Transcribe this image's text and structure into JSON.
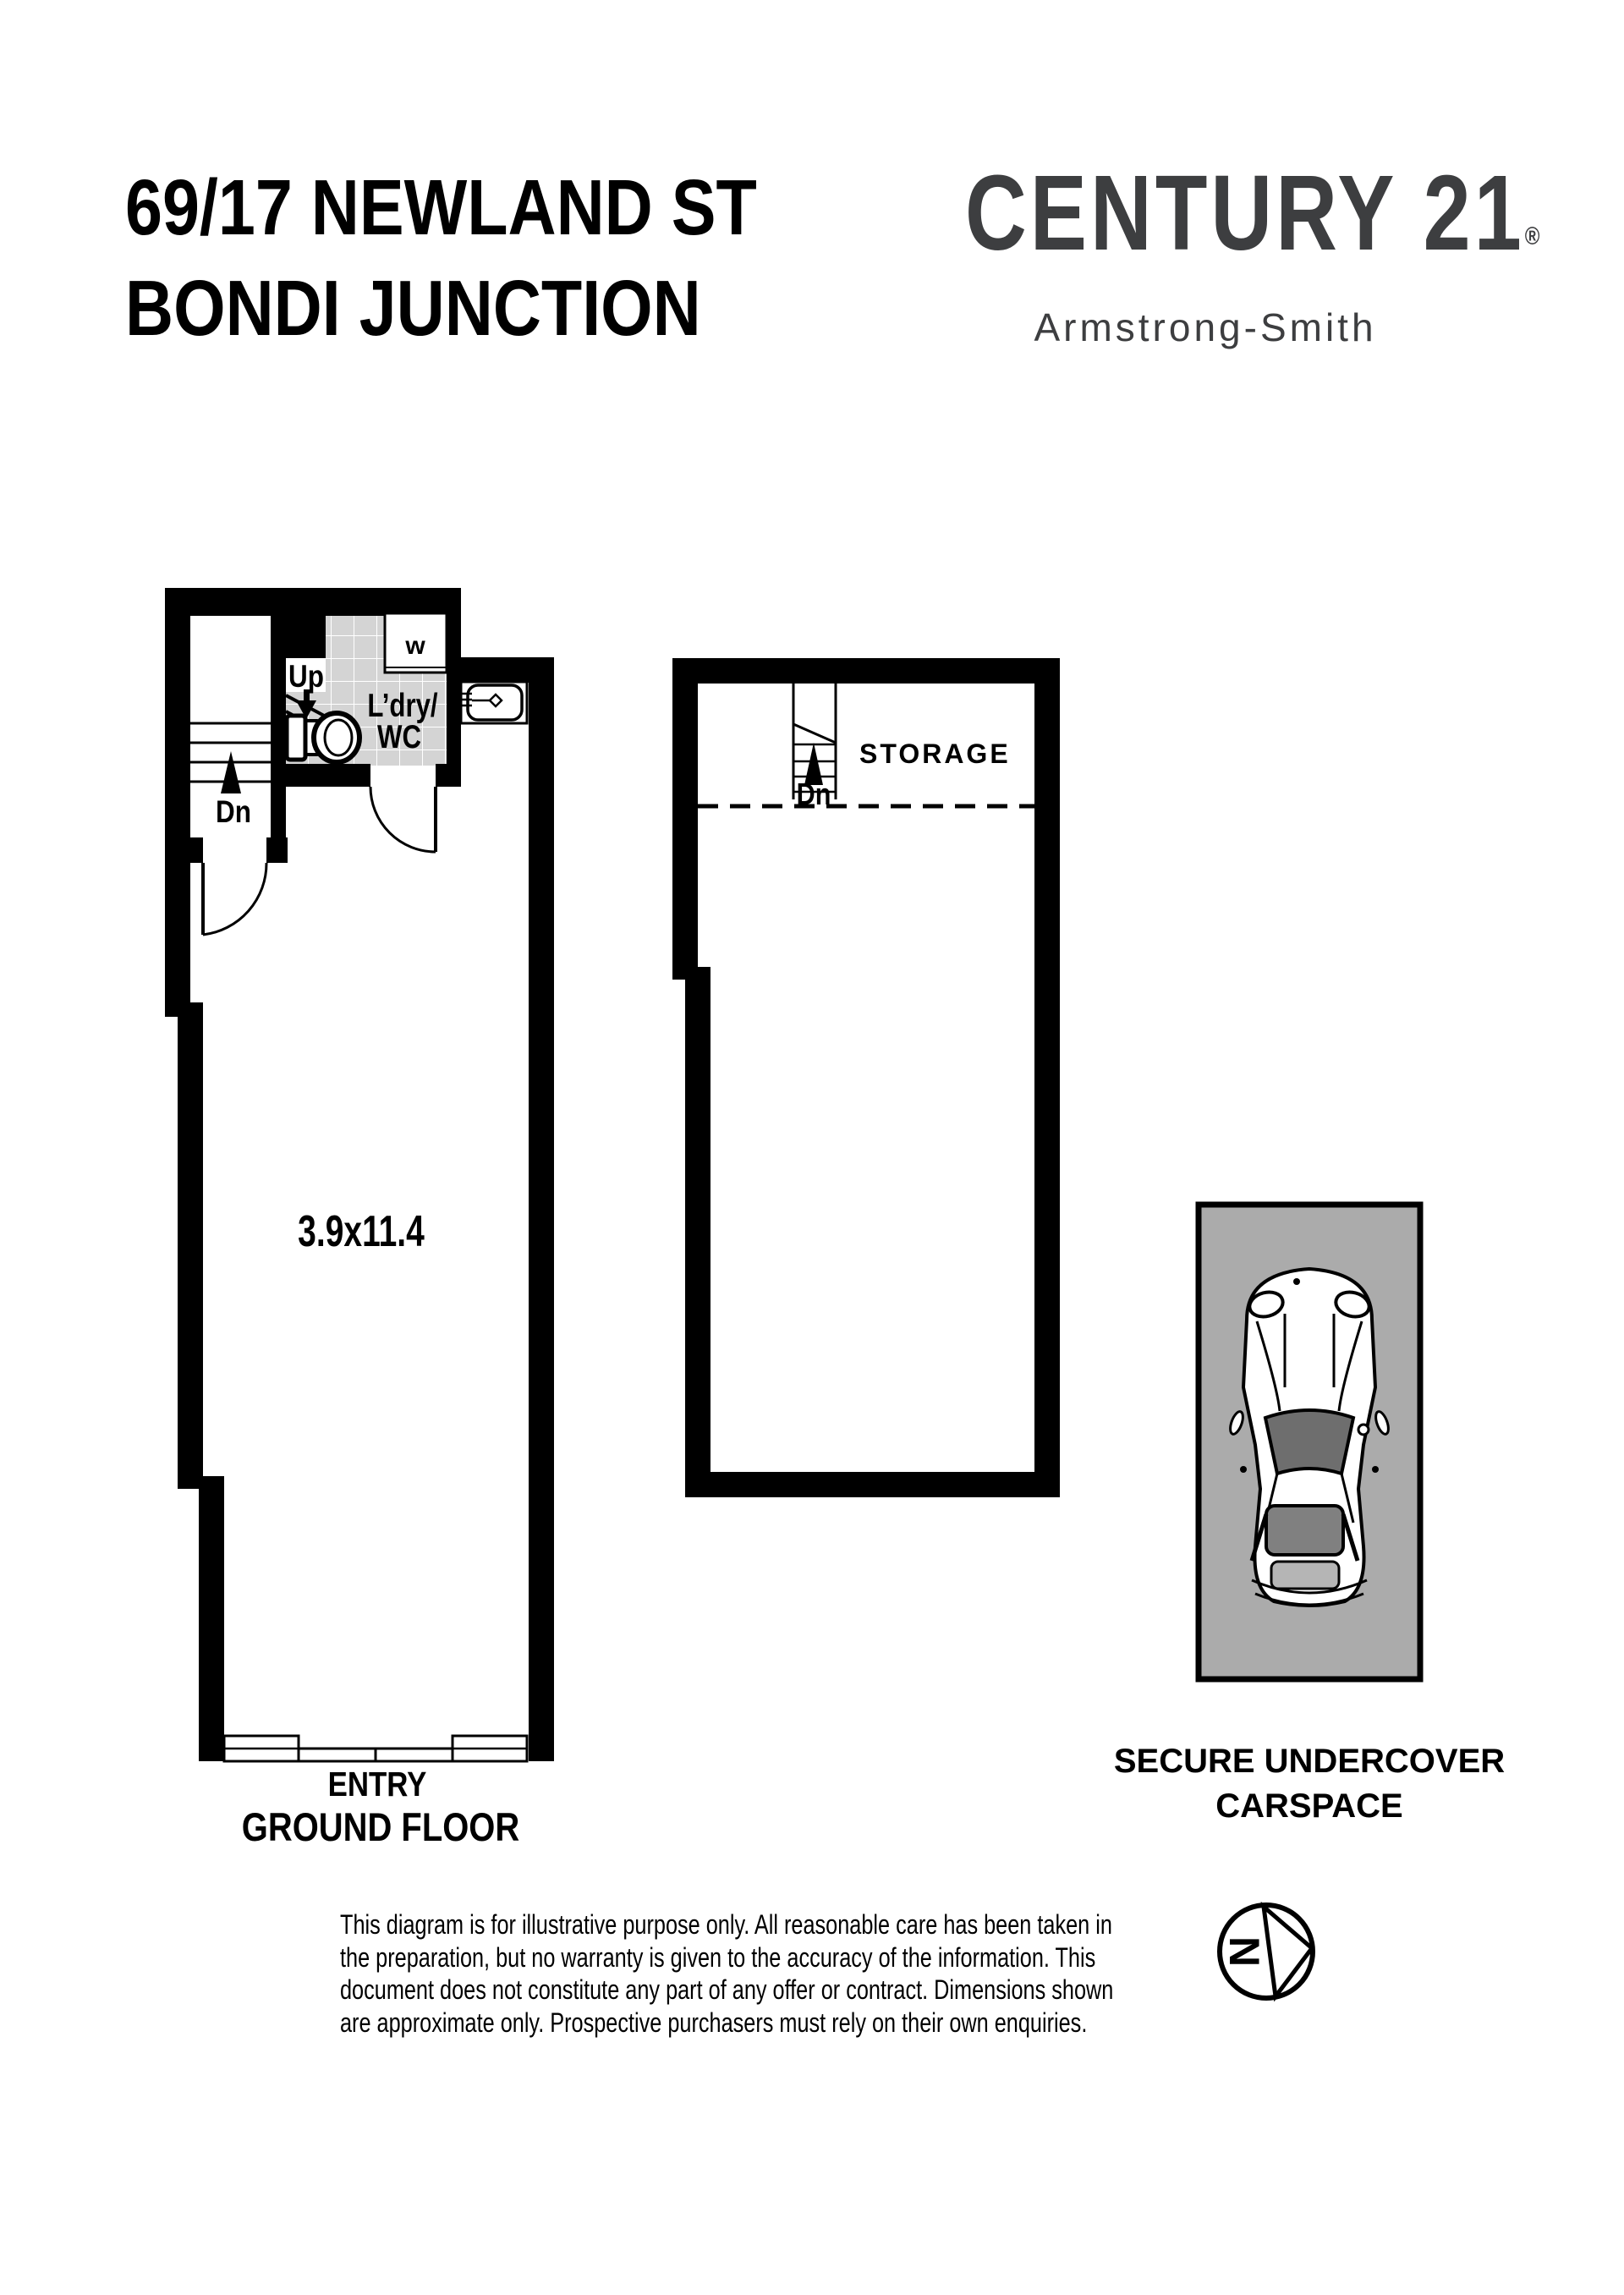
{
  "header": {
    "address_line1": "69/17 NEWLAND ST",
    "address_line2": "BONDI JUNCTION",
    "logo": {
      "brand": "CENTURY 21",
      "registered": "®",
      "office": "Armstrong-Smith",
      "color": "#3d3e40"
    }
  },
  "ground_floor": {
    "labels": {
      "up": "Up",
      "dn": "Dn",
      "laundry_line1": "L’dry/",
      "laundry_line2": "WC",
      "washer": "w",
      "dimensions": "3.9x11.4",
      "entry": "ENTRY",
      "caption": "GROUND FLOOR"
    }
  },
  "storage": {
    "label": "STORAGE",
    "stairs_dn": "Dn"
  },
  "carspace": {
    "caption": "SECURE UNDERCOVER CARSPACE"
  },
  "compass": {
    "north": "N"
  },
  "disclaimer": {
    "lines": [
      "This diagram is for illustrative purpose only. All reasonable care has been taken in",
      "the preparation, but no warranty is given to the accuracy of the information. This",
      "document does not constitute any part of any offer or contract. Dimensions shown",
      "are approximate only. Prospective purchasers must rely on their own enquiries."
    ]
  },
  "colors": {
    "wall": "#000000",
    "tile_floor": "#d4d4d4",
    "carspace_fill": "#ababab",
    "windshield": "#6e6e6e",
    "rear_window": "#808080",
    "boot_lid": "#b5b5b5",
    "logo_charcoal": "#3d3e40"
  }
}
